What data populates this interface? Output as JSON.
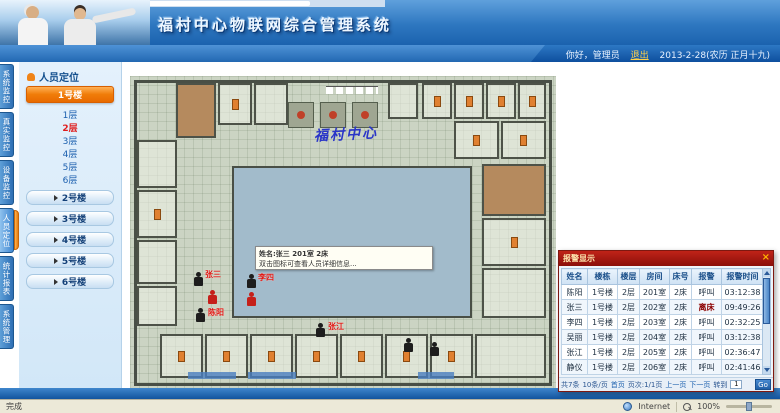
{
  "colors": {
    "header_blue": "#1b62ae",
    "accent_orange": "#f07c08",
    "alarm_red": "#8a0f0a",
    "plan_green": "#cbd4c3",
    "courtyard_blue": "#a2bbcb"
  },
  "header": {
    "title": "福村中心物联网综合管理系统"
  },
  "userbar": {
    "greeting": "你好，管理员",
    "logout_label": "退出",
    "date_text": "2013-2-28(农历 正月十九)"
  },
  "nav_tabs": [
    {
      "label": "系统监控"
    },
    {
      "label": "真实监控"
    },
    {
      "label": "设备监控"
    },
    {
      "label": "人员定位"
    },
    {
      "label": "统计报表"
    },
    {
      "label": "系统管理"
    }
  ],
  "sidebar": {
    "panel_title": "人员定位",
    "active_building": "1号楼",
    "floors": [
      "1层",
      "2层",
      "3层",
      "4层",
      "5层",
      "6层"
    ],
    "selected_floor": "2层",
    "buildings": [
      "2号楼",
      "3号楼",
      "4号楼",
      "5号楼",
      "6号楼"
    ]
  },
  "plan": {
    "building_label": "福村中心",
    "tooltip": {
      "line1": "姓名:张三  201室 2床",
      "line2": "双击图标可查看人员详细信息..."
    },
    "markers": [
      {
        "name": "张三"
      },
      {
        "name": "李四"
      },
      {
        "name": ""
      },
      {
        "name": ""
      },
      {
        "name": "陈阳"
      },
      {
        "name": "张江"
      }
    ]
  },
  "alarm_popup": {
    "title": "报警显示",
    "close_label": "×",
    "columns": [
      "姓名",
      "楼栋",
      "楼层",
      "房间",
      "床号",
      "报警",
      "报警时间"
    ],
    "rows": [
      [
        "陈阳",
        "1号楼",
        "2层",
        "201室",
        "2床",
        "呼叫",
        "03:12:38"
      ],
      [
        "张三",
        "1号楼",
        "2层",
        "202室",
        "2床",
        "离床",
        "09:49:26"
      ],
      [
        "李四",
        "1号楼",
        "2层",
        "203室",
        "2床",
        "呼叫",
        "02:32:25"
      ],
      [
        "吴丽",
        "1号楼",
        "2层",
        "204室",
        "2床",
        "呼叫",
        "03:12:38"
      ],
      [
        "张江",
        "1号楼",
        "2层",
        "205室",
        "2床",
        "呼叫",
        "02:36:47"
      ],
      [
        "静仪",
        "1号楼",
        "2层",
        "206室",
        "2床",
        "呼叫",
        "02:41:46"
      ]
    ],
    "pagination": {
      "total": "共7条",
      "per_page": "10条/页",
      "first": "首页",
      "page_info": "页次:1/1页",
      "prev": "上一页",
      "next": "下一页",
      "goto_label": "转到",
      "goto_value": "1",
      "go": "Go"
    }
  },
  "statusbar": {
    "left": "完成",
    "zone": "Internet",
    "zoom": "100%"
  }
}
